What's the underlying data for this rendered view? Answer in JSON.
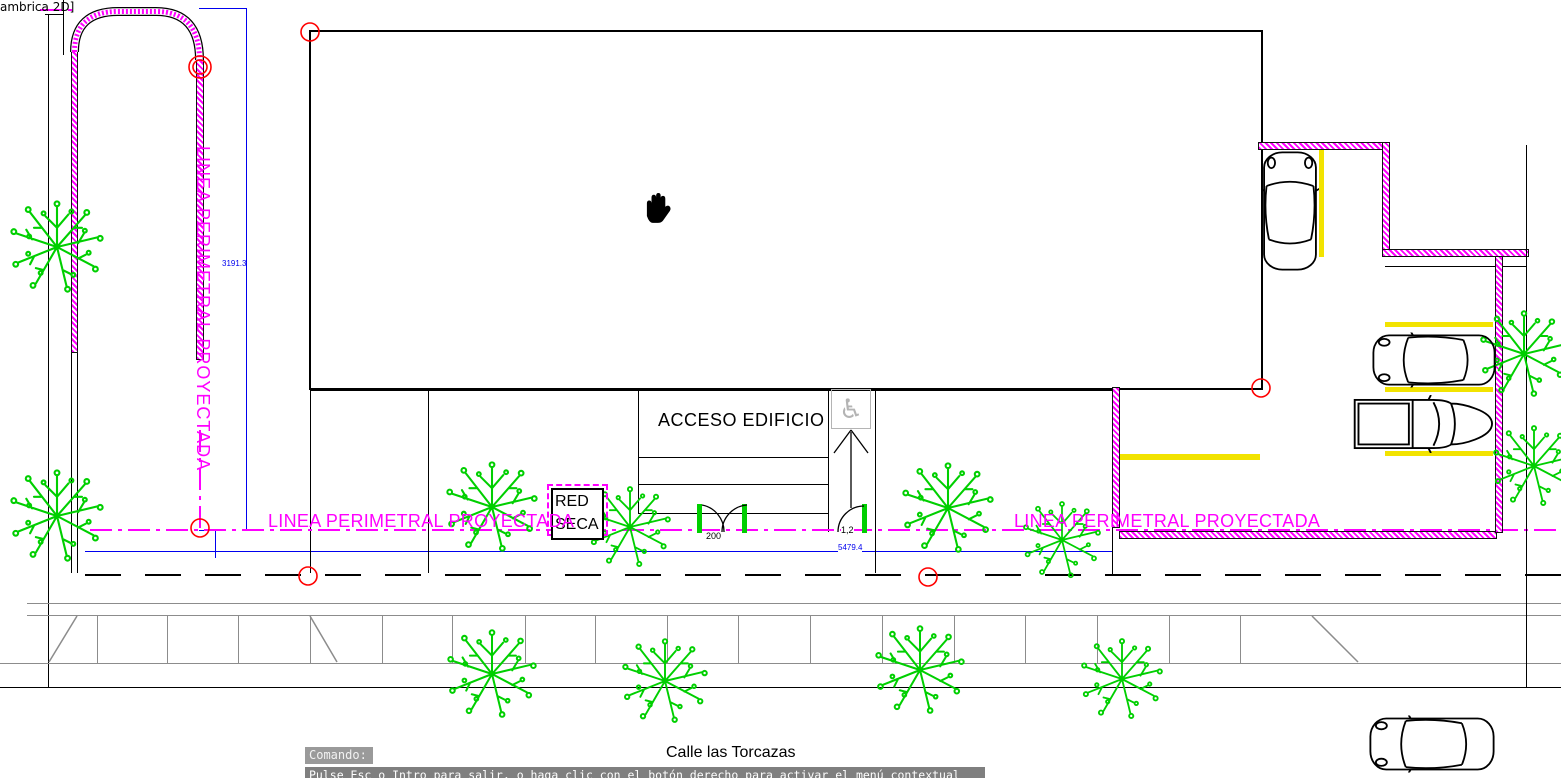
{
  "app": {
    "viewport_label": "ambrica 2D]"
  },
  "labels": {
    "linea_perimetral": "LINEA PERIMETRAL PROYECTADA",
    "acceso_edificio": "ACCESO EDIFICIO",
    "red_seca": {
      "line1": "RED",
      "line2": "SECA"
    },
    "street_name": "Calle las Torcazas"
  },
  "dimensions": {
    "perimeter_vertical": "3191.3",
    "perimeter_horizontal": "5479.4",
    "door_main_width": "200",
    "door_ramp_width": "1,2"
  },
  "command_bar": {
    "prompt": "Comando:",
    "tooltip": "Pulse Esc o Intro para salir, o haga clic con el botón derecho para activar el menú contextual"
  },
  "icons": {
    "accessibility_symbol": "♿"
  },
  "colors": {
    "magenta": "#FF00FF",
    "green": "#00CF00",
    "yellow": "#F2E300",
    "blue": "#0000EE",
    "red": "#FF0000",
    "gray_line": "#8c8c8c",
    "icon_gray": "#b4b4b4",
    "cmd_bg": "#9a9a9a",
    "tooltip_bg": "#7f7f7f"
  }
}
